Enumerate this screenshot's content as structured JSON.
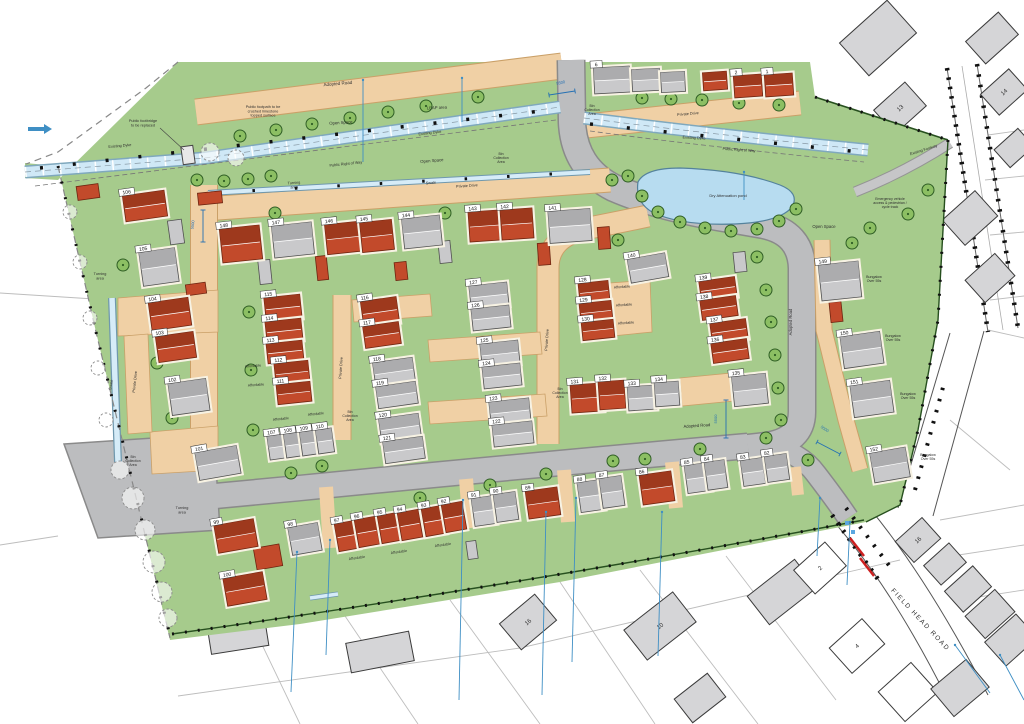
{
  "drawing": {
    "type": "residential site layout plan",
    "road_name": "FIELD HEAD ROAD"
  },
  "colors": {
    "site_green": "#a6cb8c",
    "road_gray": "#bcbdbf",
    "road_edge": "#8a8a8a",
    "drive_tan": "#f0d0a5",
    "drive_edge": "#caa068",
    "house_red": "#c24a2b",
    "house_red_dark": "#9a371c",
    "house_red_edge": "#6e2410",
    "house_gray": "#c9c9cb",
    "house_gray_dark": "#a9a9ab",
    "house_gray_edge": "#505050",
    "water": "#cfe8f6",
    "water_edge": "#7fa8bd",
    "pond": "#b7dcf0",
    "pond_edge": "#54829c",
    "tree": "#8cbf63",
    "tree_edge": "#2f5e25",
    "existing_gray": "#d5d5d7",
    "existing_edge": "#3a3a3a",
    "hedge": "#27501f",
    "drain_blue": "#3f8fc4",
    "dim_blue": "#2470b3",
    "arrow_red": "#cc2020"
  },
  "labels": [
    [
      "Adopted Road",
      338,
      85,
      -5,
      4.5
    ],
    [
      "Public footpath to be\ncrushed limestone\ntopped surface",
      263,
      108,
      0,
      3.8
    ],
    [
      "Open Space",
      341,
      124,
      -4,
      4.2
    ],
    [
      "LEAP area",
      437,
      109,
      -3,
      4.2
    ],
    [
      "Existing Dyke",
      120,
      147,
      -5,
      3.8
    ],
    [
      "Existing Dyke",
      430,
      134,
      -7,
      3.8
    ],
    [
      "Existing Dyke",
      694,
      139,
      3,
      3.8
    ],
    [
      "Public footbridge\nto be replaced",
      143,
      122,
      0,
      3.8
    ],
    [
      "Public Right of Way",
      346,
      165,
      -6,
      3.8
    ],
    [
      "Public Right of Way",
      739,
      151,
      4,
      3.8
    ],
    [
      "Open Space",
      432,
      162,
      -5,
      4.2
    ],
    [
      "Open Space",
      824,
      228,
      0,
      4.2
    ],
    [
      "Turning\narea",
      294,
      184,
      -4,
      3.8
    ],
    [
      "Swale",
      431,
      184,
      -4,
      3.8
    ],
    [
      "Private Drive",
      467,
      187,
      -4,
      3.8
    ],
    [
      "Private Drive",
      688,
      115,
      -5,
      3.8
    ],
    [
      "Dry Attenuation pond",
      728,
      197,
      0,
      4.0
    ],
    [
      "Bin\nCollection\nArea",
      592,
      107,
      0,
      3.5
    ],
    [
      "Bin\nCollection\nArea",
      501,
      155,
      0,
      3.5
    ],
    [
      "Bin\nCollection\nArea",
      350,
      413,
      0,
      3.5
    ],
    [
      "Bin\nCollection\nArea",
      560,
      390,
      0,
      3.5
    ],
    [
      "Bin\nCollection\nArea",
      133,
      458,
      0,
      3.5
    ],
    [
      "Turning\narea",
      100,
      275,
      0,
      3.8
    ],
    [
      "Turning\narea",
      182,
      509,
      0,
      3.8
    ],
    [
      "Swale",
      112,
      385,
      -80,
      3.8
    ],
    [
      "Private Drive",
      136,
      382,
      -84,
      3.8
    ],
    [
      "Private Drive",
      342,
      368,
      -86,
      3.8
    ],
    [
      "Private Drive",
      548,
      340,
      -86,
      3.8
    ],
    [
      "Adopted Road",
      697,
      427,
      -4,
      4.2
    ],
    [
      "Adopted Road",
      792,
      322,
      -90,
      4.2
    ],
    [
      "Affordable",
      253,
      367,
      -4,
      3.6
    ],
    [
      "Affordable",
      256,
      386,
      -4,
      3.6
    ],
    [
      "Affordable",
      281,
      420,
      -6,
      3.6
    ],
    [
      "Affordable",
      316,
      415,
      -6,
      3.6
    ],
    [
      "Affordable",
      622,
      288,
      -4,
      3.6
    ],
    [
      "Affordable",
      624,
      306,
      -4,
      3.6
    ],
    [
      "Affordable",
      626,
      324,
      -4,
      3.6
    ],
    [
      "Affordable",
      357,
      559,
      -8,
      3.6
    ],
    [
      "Affordable",
      399,
      553,
      -8,
      3.6
    ],
    [
      "Affordable",
      443,
      546,
      -8,
      3.6
    ],
    [
      "Bungalow\nOver 55s",
      874,
      278,
      0,
      3.6
    ],
    [
      "Bungalow\nOver 55s",
      893,
      337,
      0,
      3.6
    ],
    [
      "Bungalow\nOver 55s",
      908,
      395,
      0,
      3.6
    ],
    [
      "Bungalow\nOver 55s",
      928,
      456,
      0,
      3.6
    ],
    [
      "Emergency vehicle\naccess & pedestrian /\ncycle track",
      890,
      200,
      0,
      3.5
    ],
    [
      "Existing Footway",
      924,
      151,
      -18,
      3.8
    ],
    [
      "FIELD HEAD ROAD",
      919,
      621,
      47,
      6.5
    ]
  ],
  "dims": [
    [
      "5500",
      561,
      84,
      -12,
      [
        549,
        95,
        575,
        91
      ]
    ],
    [
      "5500",
      717,
      419,
      -90,
      [
        726,
        400,
        726,
        438
      ]
    ],
    [
      "5500",
      824,
      430,
      35,
      [
        817,
        442,
        840,
        454
      ]
    ],
    [
      "5500",
      194,
      225,
      -84,
      [
        203,
        210,
        203,
        242
      ]
    ]
  ],
  "plots": [
    [
      "148",
      241,
      244,
      40,
      34,
      -6,
      "r"
    ],
    [
      "147",
      293,
      240,
      40,
      32,
      -6,
      "g"
    ],
    [
      "146",
      343,
      238,
      34,
      30,
      -6,
      "r"
    ],
    [
      "145",
      377,
      236,
      32,
      30,
      -6,
      "r"
    ],
    [
      "144",
      422,
      232,
      38,
      30,
      -6,
      "g"
    ],
    [
      "143",
      485,
      226,
      32,
      30,
      -4,
      "r"
    ],
    [
      "142",
      517,
      224,
      32,
      30,
      -4,
      "r"
    ],
    [
      "141",
      570,
      226,
      42,
      32,
      -4,
      "g"
    ],
    [
      "140",
      648,
      268,
      38,
      24,
      -10,
      "g"
    ],
    [
      "106",
      145,
      206,
      42,
      26,
      -8,
      "r"
    ],
    [
      "105",
      159,
      267,
      36,
      34,
      -8,
      "g"
    ],
    [
      "104",
      170,
      314,
      40,
      28,
      -8,
      "r"
    ],
    [
      "103",
      176,
      347,
      38,
      26,
      -8,
      "r"
    ],
    [
      "102",
      189,
      397,
      38,
      32,
      -8,
      "g"
    ],
    [
      "101",
      218,
      463,
      42,
      28,
      -10,
      "g"
    ],
    [
      "115",
      283,
      308,
      36,
      24,
      -6,
      "r"
    ],
    [
      "114",
      284,
      331,
      36,
      22,
      -6,
      "r"
    ],
    [
      "113",
      285,
      352,
      36,
      20,
      -6,
      "r"
    ],
    [
      "112",
      292,
      373,
      34,
      22,
      -6,
      "r"
    ],
    [
      "111",
      294,
      393,
      34,
      20,
      -6,
      "r"
    ],
    [
      "107",
      277,
      447,
      17,
      24,
      -8,
      "g"
    ],
    [
      "108",
      293,
      445,
      16,
      24,
      -8,
      "g"
    ],
    [
      "109",
      309,
      443,
      16,
      24,
      -8,
      "g"
    ],
    [
      "110",
      325,
      441,
      16,
      24,
      -8,
      "g"
    ],
    [
      "116",
      380,
      312,
      36,
      26,
      -8,
      "r"
    ],
    [
      "117",
      382,
      335,
      36,
      22,
      -8,
      "r"
    ],
    [
      "118",
      394,
      372,
      40,
      24,
      -8,
      "g"
    ],
    [
      "119",
      397,
      395,
      40,
      22,
      -8,
      "g"
    ],
    [
      "120",
      400,
      428,
      40,
      24,
      -8,
      "g"
    ],
    [
      "121",
      404,
      450,
      40,
      22,
      -8,
      "g"
    ],
    [
      "127",
      489,
      296,
      38,
      24,
      -6,
      "g"
    ],
    [
      "126",
      491,
      318,
      38,
      22,
      -6,
      "g"
    ],
    [
      "125",
      500,
      354,
      38,
      24,
      -6,
      "g"
    ],
    [
      "124",
      502,
      376,
      38,
      22,
      -6,
      "g"
    ],
    [
      "123",
      510,
      412,
      40,
      24,
      -6,
      "g"
    ],
    [
      "122",
      513,
      434,
      40,
      22,
      -6,
      "g"
    ],
    [
      "128",
      594,
      292,
      30,
      20,
      -6,
      "r"
    ],
    [
      "129",
      596,
      312,
      32,
      20,
      -6,
      "r"
    ],
    [
      "130",
      598,
      330,
      32,
      18,
      -6,
      "r"
    ],
    [
      "131",
      587,
      398,
      32,
      28,
      -4,
      "r"
    ],
    [
      "132",
      612,
      395,
      26,
      28,
      -4,
      "r"
    ],
    [
      "133",
      642,
      398,
      28,
      24,
      -4,
      "g"
    ],
    [
      "134",
      667,
      394,
      24,
      24,
      -4,
      "g"
    ],
    [
      "135",
      750,
      390,
      34,
      30,
      -6,
      "g"
    ],
    [
      "139",
      718,
      289,
      36,
      20,
      -8,
      "r"
    ],
    [
      "138",
      719,
      308,
      36,
      20,
      -8,
      "r"
    ],
    [
      "137",
      729,
      331,
      36,
      20,
      -8,
      "r"
    ],
    [
      "136",
      730,
      351,
      36,
      20,
      -8,
      "r"
    ],
    [
      "149",
      840,
      281,
      40,
      36,
      -6,
      "g"
    ],
    [
      "150",
      862,
      350,
      40,
      32,
      -8,
      "g"
    ],
    [
      "151",
      872,
      399,
      40,
      32,
      -8,
      "g"
    ],
    [
      "152",
      890,
      465,
      36,
      30,
      -10,
      "g"
    ],
    [
      "99",
      236,
      536,
      40,
      28,
      -10,
      "r"
    ],
    [
      "100",
      245,
      589,
      40,
      28,
      -10,
      "r"
    ],
    [
      "98",
      305,
      539,
      30,
      28,
      -10,
      "g"
    ],
    [
      "97",
      347,
      536,
      21,
      28,
      -10,
      "r"
    ],
    [
      "96",
      367,
      532,
      21,
      28,
      -10,
      "r"
    ],
    [
      "95",
      390,
      528,
      21,
      28,
      -10,
      "r"
    ],
    [
      "94",
      410,
      525,
      21,
      28,
      -10,
      "r"
    ],
    [
      "93",
      434,
      521,
      21,
      28,
      -10,
      "r"
    ],
    [
      "92",
      454,
      517,
      21,
      28,
      -10,
      "r"
    ],
    [
      "91",
      484,
      511,
      22,
      28,
      -8,
      "g"
    ],
    [
      "90",
      506,
      507,
      22,
      28,
      -8,
      "g"
    ],
    [
      "89",
      543,
      503,
      32,
      28,
      -8,
      "r"
    ],
    [
      "88",
      591,
      496,
      24,
      30,
      -8,
      "g"
    ],
    [
      "87",
      612,
      492,
      22,
      30,
      -8,
      "g"
    ],
    [
      "86",
      657,
      488,
      32,
      30,
      -8,
      "r"
    ],
    [
      "85",
      698,
      478,
      24,
      28,
      -8,
      "g"
    ],
    [
      "84",
      716,
      475,
      20,
      28,
      -8,
      "g"
    ],
    [
      "83",
      753,
      472,
      22,
      26,
      -8,
      "g"
    ],
    [
      "82",
      777,
      468,
      22,
      26,
      -8,
      "g"
    ],
    [
      "6",
      612,
      80,
      36,
      26,
      -3,
      "g"
    ],
    [
      null,
      646,
      80,
      28,
      22,
      -3,
      "g"
    ],
    [
      null,
      673,
      82,
      24,
      20,
      -3,
      "g"
    ],
    [
      null,
      715,
      81,
      24,
      18,
      -4,
      "r"
    ],
    [
      "2",
      748,
      86,
      28,
      22,
      -4,
      "r"
    ],
    [
      "1",
      779,
      85,
      28,
      22,
      -4,
      "r"
    ]
  ],
  "garages": {
    "red": [
      [
        88,
        192,
        22,
        14,
        -8
      ],
      [
        210,
        198,
        24,
        12,
        -6
      ],
      [
        196,
        289,
        20,
        11,
        -8
      ],
      [
        322,
        268,
        11,
        24,
        -6
      ],
      [
        401,
        271,
        12,
        18,
        -6
      ],
      [
        544,
        254,
        12,
        22,
        -4
      ],
      [
        604,
        238,
        12,
        22,
        -4
      ],
      [
        268,
        557,
        26,
        22,
        -10
      ],
      [
        836,
        312,
        12,
        20,
        -6
      ]
    ],
    "gray": [
      [
        176,
        232,
        14,
        24,
        -8
      ],
      [
        265,
        272,
        12,
        24,
        -6
      ],
      [
        445,
        252,
        12,
        22,
        -6
      ],
      [
        740,
        262,
        12,
        20,
        -6
      ],
      [
        472,
        550,
        10,
        18,
        -8
      ]
    ]
  },
  "existing_houses": [
    [
      878,
      38,
      64,
      44,
      -42,
      "g",
      null
    ],
    [
      900,
      108,
      42,
      32,
      -42,
      "g",
      "13"
    ],
    [
      992,
      38,
      44,
      30,
      -42,
      "g",
      null
    ],
    [
      1004,
      92,
      38,
      28,
      -42,
      "g",
      "14"
    ],
    [
      1014,
      148,
      32,
      24,
      -42,
      "g",
      null
    ],
    [
      970,
      218,
      44,
      34,
      -42,
      "g",
      null
    ],
    [
      990,
      278,
      40,
      30,
      -42,
      "g",
      null
    ],
    [
      238,
      636,
      58,
      28,
      -9,
      "g",
      null
    ],
    [
      380,
      652,
      64,
      30,
      -11,
      "g",
      null
    ],
    [
      528,
      622,
      46,
      34,
      -40,
      "g",
      "16"
    ],
    [
      660,
      626,
      62,
      38,
      -38,
      "g",
      "10"
    ],
    [
      782,
      592,
      60,
      36,
      -38,
      "g",
      null
    ],
    [
      918,
      540,
      36,
      28,
      -42,
      "g",
      "16"
    ],
    [
      945,
      564,
      34,
      26,
      -42,
      "g",
      null
    ],
    [
      968,
      589,
      38,
      28,
      -42,
      "g",
      null
    ],
    [
      990,
      614,
      40,
      30,
      -42,
      "g",
      null
    ],
    [
      1011,
      640,
      42,
      32,
      -42,
      "g",
      null
    ],
    [
      820,
      568,
      42,
      32,
      -42,
      "w",
      "2"
    ],
    [
      857,
      646,
      44,
      34,
      -42,
      "w",
      "4"
    ],
    [
      908,
      692,
      44,
      40,
      -42,
      "w",
      null
    ],
    [
      700,
      698,
      42,
      30,
      -38,
      "g",
      null
    ],
    [
      960,
      688,
      46,
      36,
      -40,
      "g",
      null
    ]
  ],
  "trees": {
    "green": [
      [
        240,
        136
      ],
      [
        276,
        130
      ],
      [
        312,
        124
      ],
      [
        350,
        118
      ],
      [
        388,
        112
      ],
      [
        426,
        106
      ],
      [
        478,
        97
      ],
      [
        197,
        180
      ],
      [
        224,
        181
      ],
      [
        248,
        179
      ],
      [
        271,
        176
      ],
      [
        642,
        98
      ],
      [
        671,
        99
      ],
      [
        702,
        100
      ],
      [
        739,
        103
      ],
      [
        779,
        105
      ],
      [
        628,
        176
      ],
      [
        642,
        196
      ],
      [
        658,
        212
      ],
      [
        680,
        222
      ],
      [
        705,
        228
      ],
      [
        731,
        231
      ],
      [
        757,
        229
      ],
      [
        779,
        221
      ],
      [
        796,
        209
      ],
      [
        612,
        180
      ],
      [
        870,
        228
      ],
      [
        908,
        214
      ],
      [
        852,
        243
      ],
      [
        928,
        190
      ],
      [
        757,
        257
      ],
      [
        766,
        290
      ],
      [
        771,
        322
      ],
      [
        775,
        355
      ],
      [
        778,
        388
      ],
      [
        781,
        420
      ],
      [
        123,
        265
      ],
      [
        157,
        363
      ],
      [
        172,
        418
      ],
      [
        246,
        254
      ],
      [
        249,
        312
      ],
      [
        251,
        370
      ],
      [
        253,
        430
      ],
      [
        275,
        213
      ],
      [
        445,
        213
      ],
      [
        618,
        240
      ],
      [
        291,
        473
      ],
      [
        322,
        466
      ],
      [
        420,
        498
      ],
      [
        490,
        485
      ],
      [
        546,
        474
      ],
      [
        613,
        461
      ],
      [
        645,
        459
      ],
      [
        700,
        449
      ],
      [
        766,
        438
      ],
      [
        228,
        470
      ],
      [
        808,
        460
      ]
    ],
    "outline": [
      [
        133,
        498,
        11
      ],
      [
        145,
        530,
        10
      ],
      [
        154,
        562,
        11
      ],
      [
        162,
        592,
        10
      ],
      [
        168,
        618,
        9
      ],
      [
        120,
        470,
        9
      ],
      [
        70,
        212,
        7
      ],
      [
        80,
        262,
        7
      ],
      [
        90,
        318,
        7
      ],
      [
        98,
        368,
        7
      ],
      [
        106,
        420,
        7
      ],
      [
        210,
        152,
        9
      ],
      [
        236,
        158,
        8
      ]
    ]
  },
  "drains": [
    [
      297,
      552,
      291,
      692
    ],
    [
      330,
      540,
      326,
      655
    ],
    [
      463,
      500,
      459,
      700
    ],
    [
      546,
      512,
      542,
      695
    ],
    [
      576,
      498,
      572,
      662
    ],
    [
      662,
      512,
      658,
      656
    ],
    [
      820,
      498,
      817,
      556
    ],
    [
      850,
      522,
      847,
      585
    ],
    [
      955,
      645,
      990,
      693
    ],
    [
      1000,
      655,
      1024,
      700
    ],
    [
      363,
      80,
      363,
      162
    ],
    [
      462,
      78,
      462,
      122
    ],
    [
      744,
      172,
      744,
      200
    ]
  ]
}
